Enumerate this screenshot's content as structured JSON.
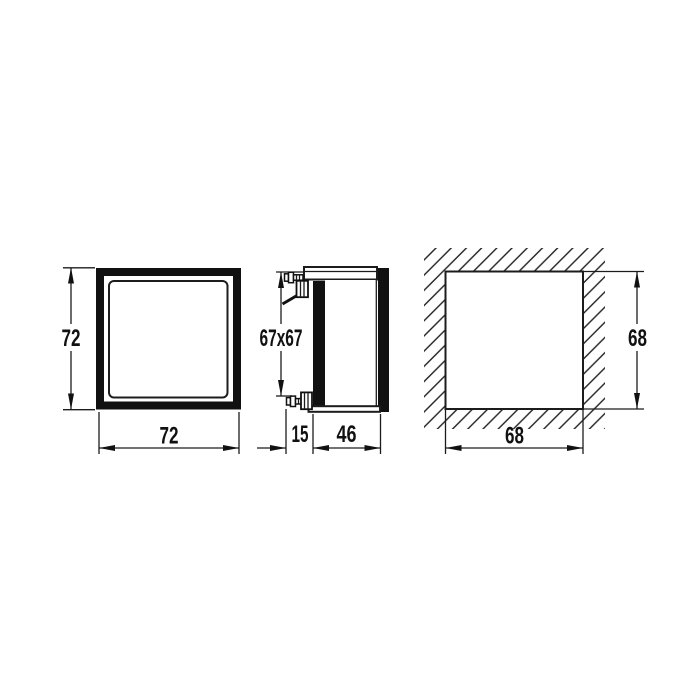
{
  "colors": {
    "line": "#1c1c1c",
    "solid_fill": "#111111",
    "background": "#ffffff"
  },
  "views": {
    "front": {
      "height_label": "72",
      "width_label": "72"
    },
    "side": {
      "bezel_label": "67x67",
      "front_depth_label": "15",
      "body_depth_label": "46"
    },
    "panel_cutout": {
      "height_label": "68",
      "width_label": "68"
    }
  }
}
